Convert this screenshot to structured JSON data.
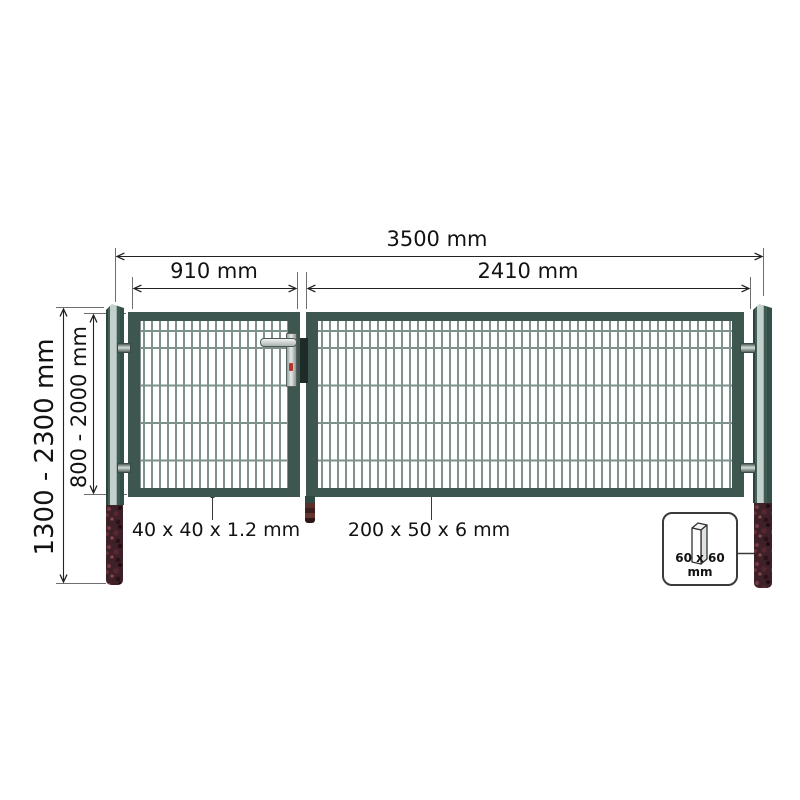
{
  "diagram": {
    "dimensions": {
      "total_width": "3500 mm",
      "left_leaf_width": "910 mm",
      "right_leaf_width": "2410 mm",
      "post_height": "1300 - 2300 mm",
      "gate_height": "800 - 2000 mm"
    },
    "specs": {
      "frame_profile": "40 x 40 x 1.2 mm",
      "panel_profile": "200 x 50 x 6 mm",
      "post_section": "60 x 60 mm"
    },
    "icons": {
      "post_cross_section": "3d-square-post",
      "handle": "gate-handle",
      "hinge": "gate-hinge"
    },
    "colors": {
      "frame_green": "#3d5650",
      "mesh_wire": "#7e918d",
      "post_light": "#c4d0cb",
      "buried_post": "#3e2128",
      "dimension_line": "#6f6f6f",
      "text": "#121212"
    }
  }
}
